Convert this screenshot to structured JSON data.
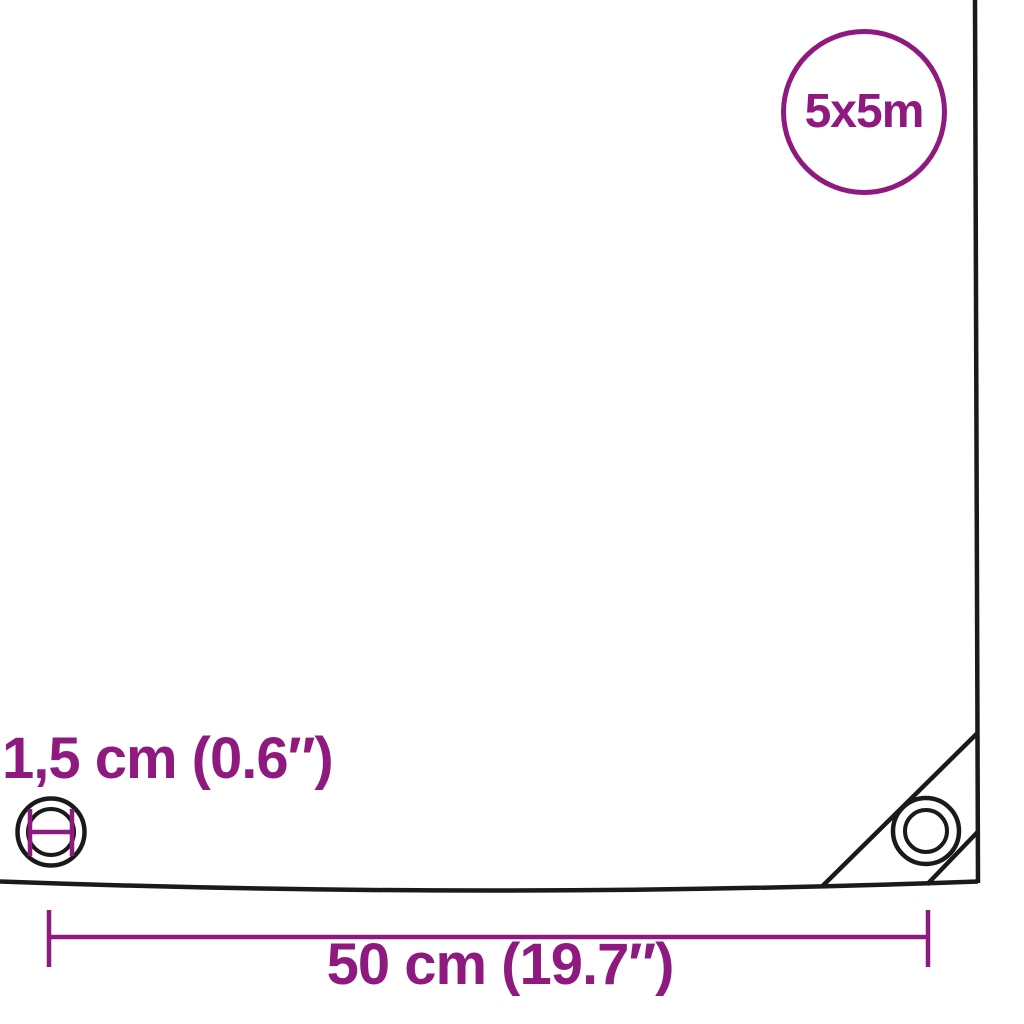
{
  "colors": {
    "accent": "#8E1A80",
    "line": "#1A1A1A",
    "background": "#FFFFFF"
  },
  "size_badge": {
    "label": "5x5m"
  },
  "dimensions": {
    "grommet_diameter_label": "1,5 cm (0.6″)",
    "grommet_spacing_label": "50 cm (19.7″)"
  }
}
